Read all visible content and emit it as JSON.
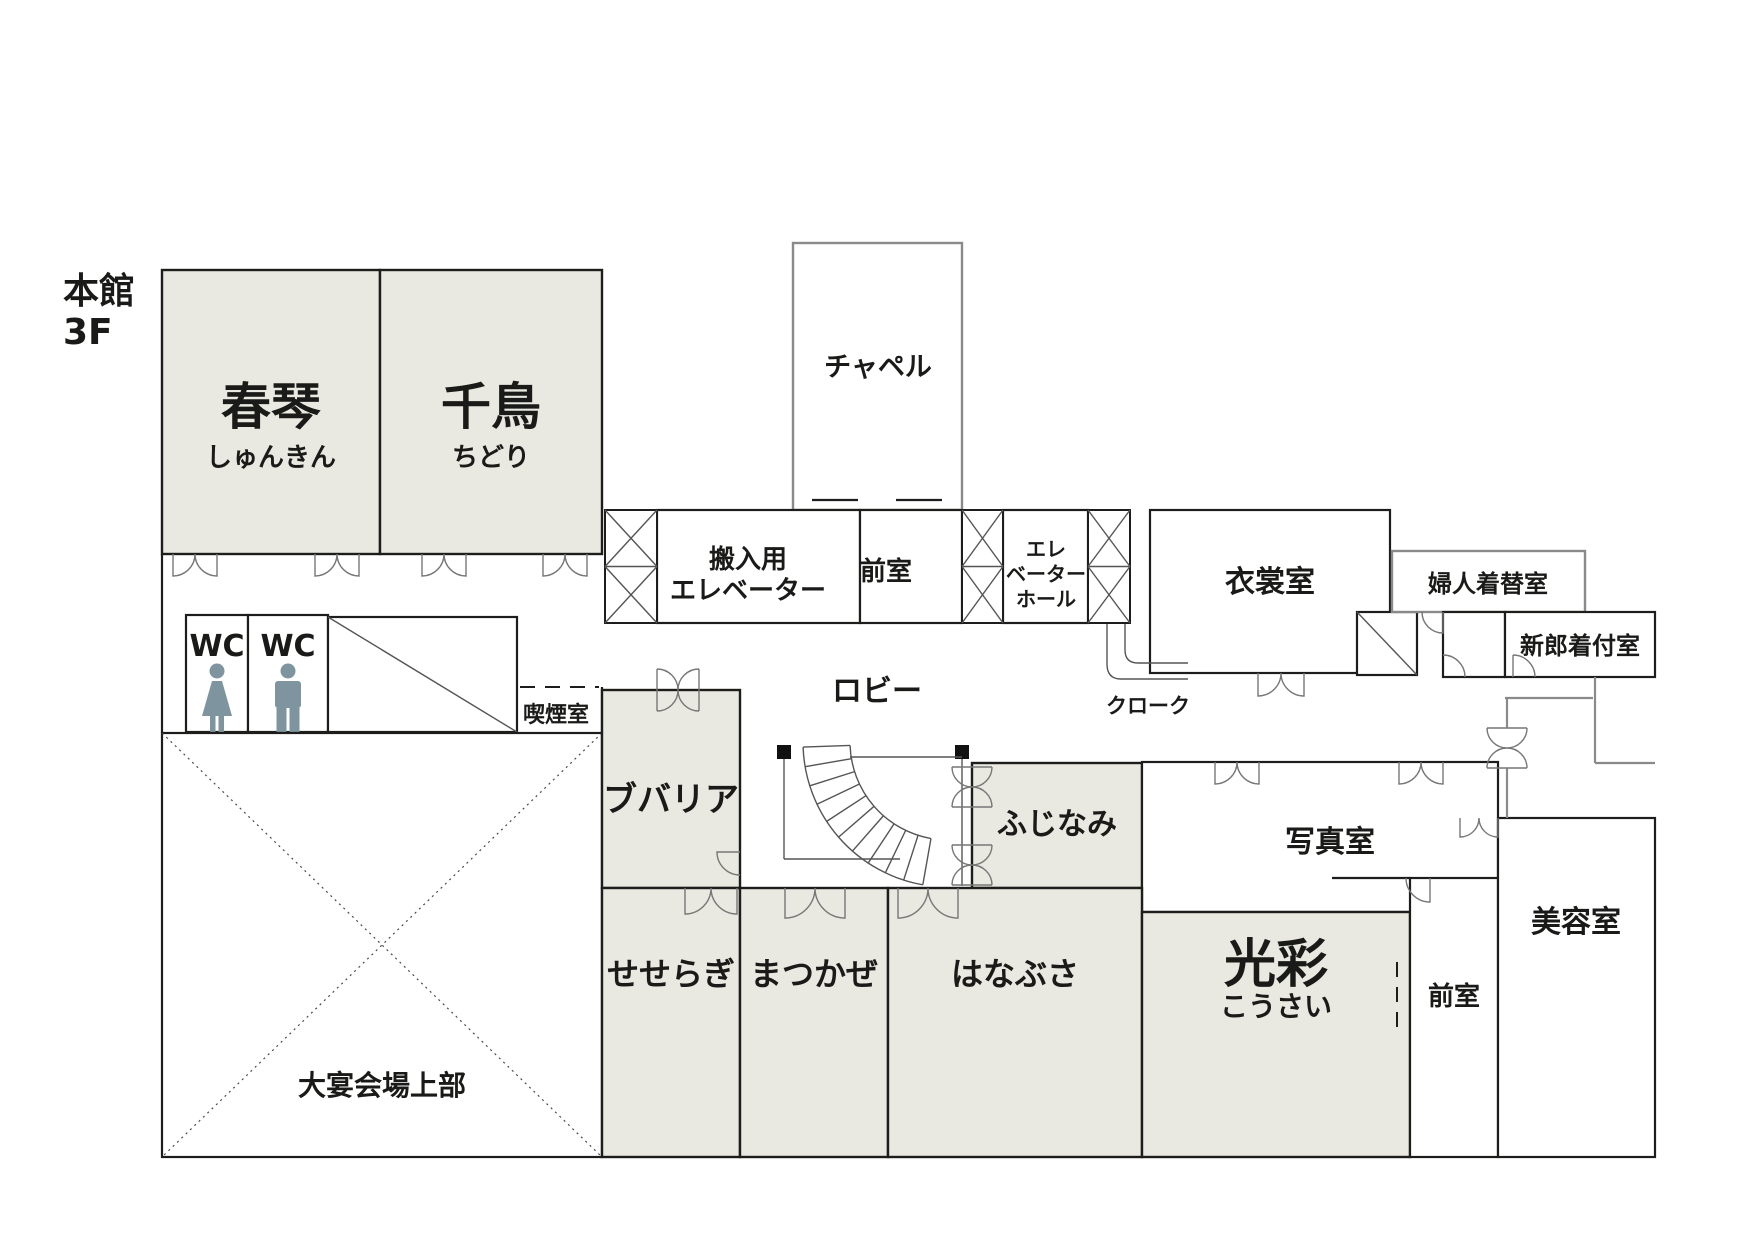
{
  "title": {
    "building": "本館",
    "floor": "3F"
  },
  "rooms": {
    "shunkin": {
      "label": "春琴",
      "kana": "しゅんきん"
    },
    "chidori": {
      "label": "千鳥",
      "kana": "ちどり"
    },
    "chapel": {
      "label": "チャペル"
    },
    "service_elevator": {
      "line1": "搬入用",
      "line2": "エレベーター"
    },
    "chapel_anteroom": {
      "label": "前室"
    },
    "elevator_hall": {
      "line1": "エレ",
      "line2": "ベーター",
      "line3": "ホール"
    },
    "costume_room": {
      "label": "衣裳室"
    },
    "womens_changing_room": {
      "label": "婦人着替室"
    },
    "grooms_dressing_room": {
      "label": "新郎着付室"
    },
    "wc_women": {
      "label": "WC"
    },
    "wc_men": {
      "label": "WC"
    },
    "smoking_room": {
      "label": "喫煙室"
    },
    "lobby": {
      "label": "ロビー"
    },
    "cloak": {
      "label": "クローク"
    },
    "bouvardia": {
      "label": "ブバリア"
    },
    "fujinami": {
      "label": "ふじなみ"
    },
    "photo_room": {
      "label": "写真室"
    },
    "banquet_hall_upper": {
      "label": "大宴会場上部"
    },
    "seseragi": {
      "label": "せせらぎ"
    },
    "matsukaze": {
      "label": "まつかぜ"
    },
    "hanabusa": {
      "label": "はなぶさ"
    },
    "kousai": {
      "label": "光彩",
      "kana": "こうさい"
    },
    "kousai_anteroom": {
      "label": "前室"
    },
    "beauty_salon": {
      "label": "美容室"
    }
  },
  "colors": {
    "background": "#ffffff",
    "room_fill": "#e9e8e1",
    "wall": "#1d1d1b",
    "wall_gray": "#8a8a8a",
    "icon": "#7e949e",
    "text": "#1a1a18"
  }
}
